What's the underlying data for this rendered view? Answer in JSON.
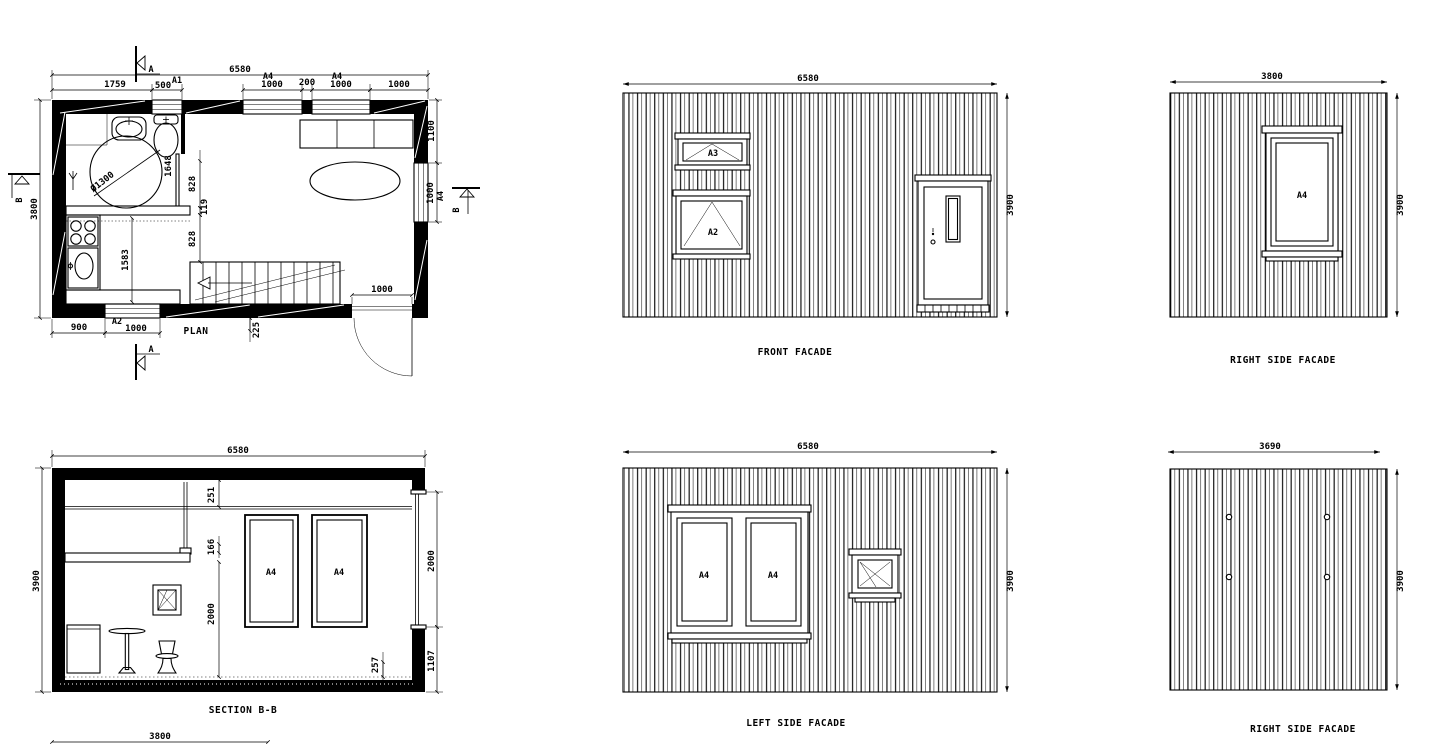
{
  "canvas": {
    "background": "#ffffff",
    "ink": "#000000"
  },
  "plan": {
    "title": "PLAN",
    "section_marker_a": "A",
    "section_marker_b": "B",
    "window_tags": {
      "a1": "A1",
      "a2": "A2",
      "a4_top_left": "A4",
      "a4_top_right": "A4",
      "a4_right": "A4"
    },
    "dims": {
      "overall_width": "6580",
      "bath_width": "1759",
      "bath_window": "500",
      "win_left": "1000",
      "pier": "200",
      "win_right": "1000",
      "corner": "1000",
      "overall_depth": "3800",
      "right_upper": "1100",
      "right_window": "1000",
      "bottom_left": "900",
      "bottom_window": "1000",
      "door_width": "1000",
      "stair_edge": "225",
      "kitchen_depth": "1583",
      "slide_door": "1648",
      "wall_upper": "828",
      "wall_mid": "119",
      "wall_lower": "828",
      "shower_diameter": "Ø1300"
    }
  },
  "section": {
    "title": "SECTION B-B",
    "window_tags": [
      "A4",
      "A4"
    ],
    "dims": {
      "overall_width": "6580",
      "overall_height": "3900",
      "foundation_width": "3800",
      "ceiling_gap": "251",
      "loft_edge": "166",
      "clear_height": "2000",
      "window_height": "2000",
      "window_sill": "1107",
      "floor_edge": "257"
    }
  },
  "front_facade": {
    "title": "FRONT FACADE",
    "dims": {
      "width": "6580",
      "height": "3900"
    },
    "window_tags": {
      "upper": "A3",
      "lower": "A2"
    }
  },
  "right_facade_upper": {
    "title": "RIGHT SIDE FACADE",
    "dims": {
      "width": "3800",
      "height": "3900"
    },
    "window_tag": "A4"
  },
  "left_facade": {
    "title": "LEFT SIDE FACADE",
    "dims": {
      "width": "6580",
      "height": "3900"
    },
    "window_tags": [
      "A4",
      "A4"
    ]
  },
  "right_facade_lower": {
    "title": "RIGHT SIDE FACADE",
    "dims": {
      "width": "3690",
      "height": "3900"
    }
  }
}
